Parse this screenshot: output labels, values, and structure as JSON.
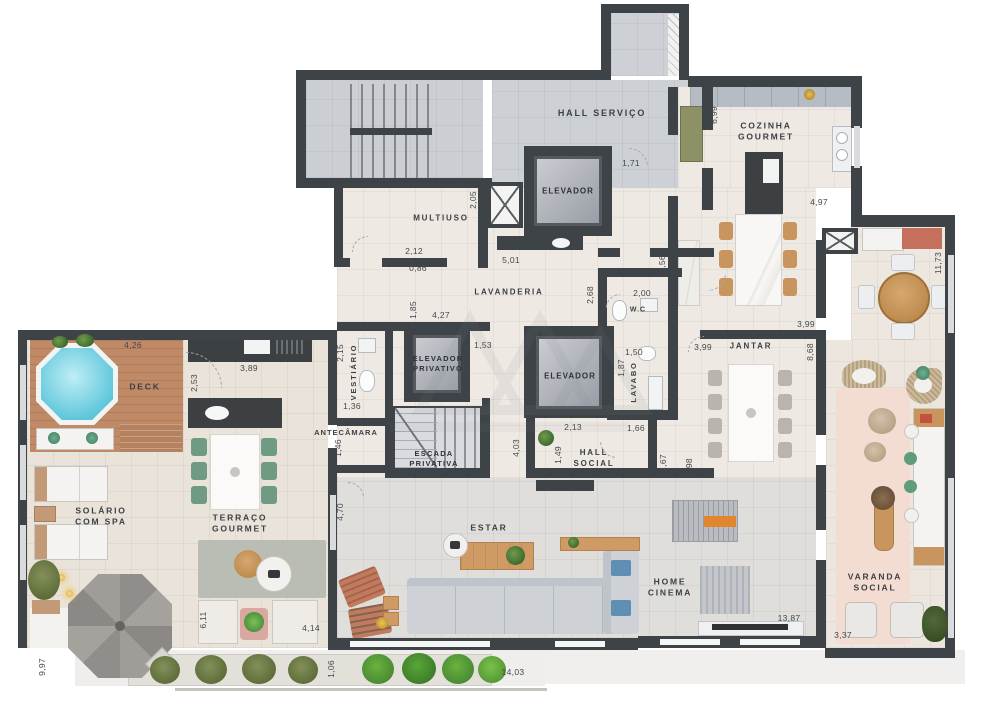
{
  "plan_title": "Penthouse floor plan",
  "rooms": {
    "hall_servico": "HALL SERVIÇO",
    "elevador_servico": "ELEVADOR",
    "multiuso": "MULTIUSO",
    "lavanderia": "LAVANDERIA",
    "wc": "W.C",
    "cozinha_gourmet": "COZINHA\nGOURMET",
    "vestiario": "VESTIÁRIO",
    "elevador_privativo": "ELEVADOR\nPRIVATIVO",
    "elevador_social": "ELEVADOR",
    "lavabo": "LAVABO",
    "antecamara": "ANTECÂMARA",
    "escada_privativa": "ESCADA\nPRIVATIVA",
    "hall_social": "HALL\nSOCIAL",
    "jantar": "JANTAR",
    "deck": "DECK",
    "solario": "SOLÁRIO\nCOM SPA",
    "terraco_gourmet": "TERRAÇO\nGOURMET",
    "estar": "ESTAR",
    "home_cinema": "HOME\nCINEMA",
    "varanda_social": "VARANDA\nSOCIAL"
  },
  "dims": {
    "deck_top": "4,26",
    "bancada_terraco": "3,89",
    "bancada_lado": "2,53",
    "vestiario_l": "2,15",
    "vestiario_w": "1,36",
    "antecamara_w": "1,46",
    "elevpriv_esq": "1,85",
    "elevpriv_top": "4,27",
    "corredor_153": "1,53",
    "multiuso_w": "2,12",
    "multiuso_p": "0,86",
    "multiuso_l": "2,05",
    "hall_serv_porta": "1,71",
    "lavanderia_w": "5,01",
    "lavanderia_l": "3,56",
    "wc_l": "2,68",
    "wc_w": "2,00",
    "cozinha_l": "6,99",
    "cozinha_w": "4,97",
    "terraco_cafe_l": "11,73",
    "jantar_top_r": "3,99",
    "jantar_top_l": "3,99",
    "jantar_l": "8,68",
    "lavabo_w": "1,50",
    "lavabo_l": "1,87",
    "lavabo_bottom": "1,66",
    "porta_167": "1,67",
    "jantar_b": "3,98",
    "hall_social_w": "2,13",
    "hall_social_l": "1,49",
    "corredor_403": "4,03",
    "estar_esq": "4,70",
    "solario_l": "9,97",
    "terraco_611": "6,11",
    "terraco_414": "4,14",
    "jardineira_w": "1,06",
    "estar_b": "14,03",
    "varanda_l": "13,87",
    "varanda_w": "3,37"
  }
}
